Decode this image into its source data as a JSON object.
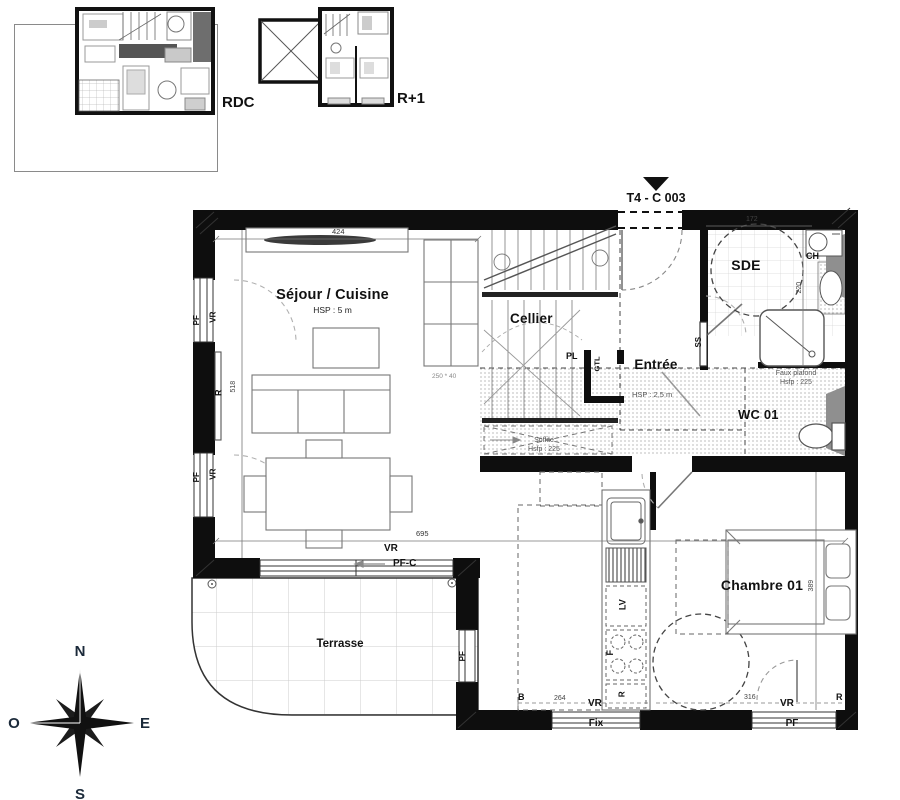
{
  "marker": {
    "unit": "T4 - C 003"
  },
  "thumbnails": {
    "rdc": "RDC",
    "r1": "R+1"
  },
  "rooms": {
    "sejour": {
      "name": "Séjour / Cuisine",
      "hsp": "HSP : 5 m"
    },
    "cellier": {
      "name": "Cellier"
    },
    "entree": {
      "name": "Entrée",
      "hsp": "HSP : 2,5 m"
    },
    "sde": {
      "name": "SDE"
    },
    "wc": {
      "name": "WC 01"
    },
    "chambre": {
      "name": "Chambre 01"
    },
    "terrasse": {
      "name": "Terrasse"
    }
  },
  "annotations": {
    "faux_plafond": [
      "Faux plafond",
      "Hsfp : 225"
    ],
    "soffite": [
      "Soffite",
      "Hsfp : 225"
    ],
    "size_note": "250 * 40"
  },
  "dims": {
    "d424": "424",
    "d518": "518",
    "d695": "695",
    "d172": "172",
    "d220": "220",
    "d389": "389",
    "d264": "264",
    "d316": "316"
  },
  "equipment": {
    "pl": "PL",
    "gtl": "GTL",
    "ss": "SS",
    "ch": "CH",
    "lv": "LV",
    "four": "F",
    "fridge": "R",
    "radiator": "R",
    "b": "B"
  },
  "openings": {
    "pf": "PF",
    "vr": "VR",
    "pfc": "PF-C",
    "fix": "Fix"
  },
  "compass": {
    "n": "N",
    "o": "O",
    "e": "E",
    "s": "S"
  },
  "colors": {
    "wall": "#0e0e0e",
    "furniture": "#777777",
    "hatch": "#9a9a9a",
    "tile": "#cccccc"
  }
}
